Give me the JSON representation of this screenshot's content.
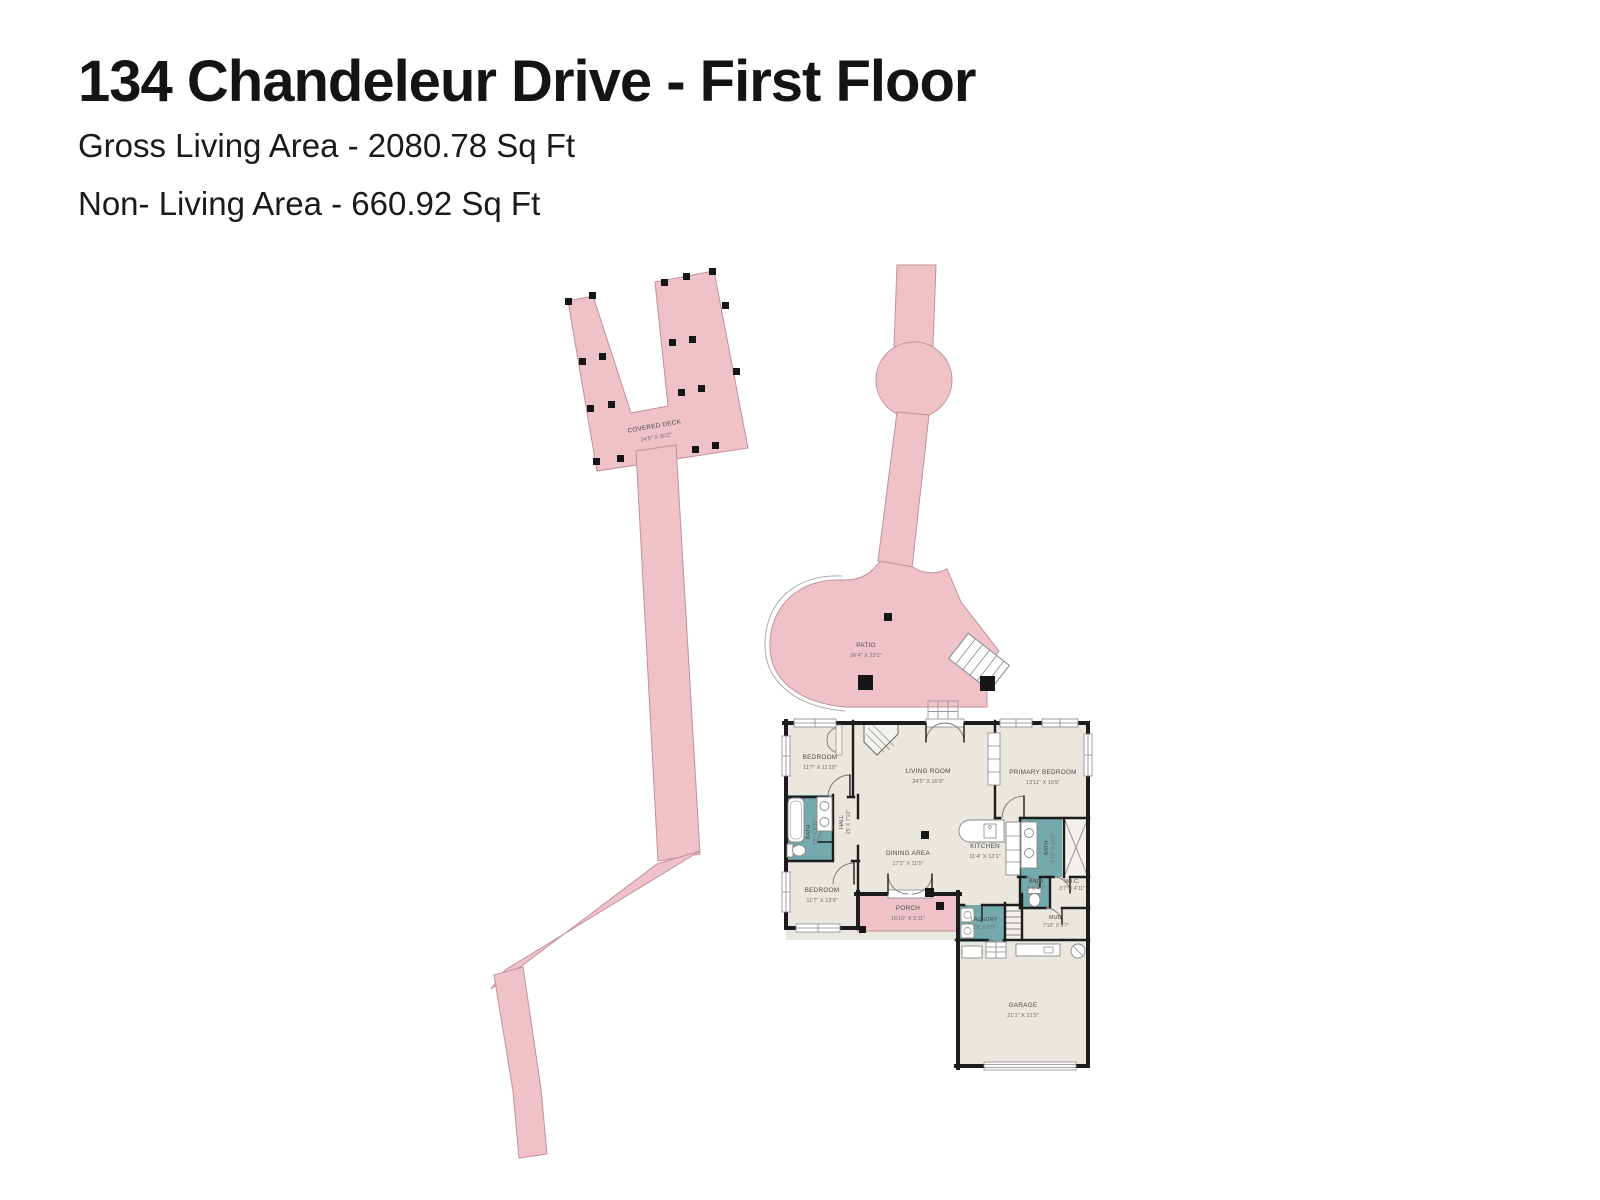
{
  "header": {
    "title": "134 Chandeleur Drive - First Floor",
    "gross_living": "Gross Living Area - 2080.78 Sq Ft",
    "non_living": "Non- Living Area - 660.92 Sq Ft"
  },
  "colors": {
    "outdoor_pink": "#eec2c8",
    "outdoor_stroke": "#c49099",
    "floor_beige": "#e9e7de",
    "bath_teal": "#74a9ae",
    "wall_black": "#1c1c1c"
  },
  "plan": {
    "covered_deck": {
      "label": "COVERED DECK",
      "dims": "24'5\" X 30'2\""
    },
    "patio": {
      "label": "PATIO",
      "dims": "36'4\" X 23'1\""
    },
    "bedroom1": {
      "label": "BEDROOM",
      "dims": "11'7\" X 11'10\""
    },
    "living_room": {
      "label": "LIVING ROOM",
      "dims": "24'5\" X 16'9\""
    },
    "primary_bedroom": {
      "label": "PRIMARY BEDROOM",
      "dims": "13'11\" X 16'5\""
    },
    "bath1": {
      "label": "BATH",
      "dims": "7'5\" X 9'10\""
    },
    "hall": {
      "label": "HALL",
      "dims": "25' X 7'10\""
    },
    "dining": {
      "label": "DINING AREA",
      "dims": "17'2\" X 11'5\""
    },
    "kitchen": {
      "label": "KITCHEN",
      "dims": "11'4\" X 13'1\""
    },
    "primary_bath": {
      "label": "BATH",
      "dims": "5'10\" X 14'3\""
    },
    "bedroom2": {
      "label": "BEDROOM",
      "dims": "11'7\" X 13'9\""
    },
    "porch": {
      "label": "PORCH",
      "dims": "16'10\" X 5'11\""
    },
    "laundry": {
      "label": "LAUNDRY",
      "dims": "7'5\" X 6'9\""
    },
    "bath2": {
      "label": "BATH",
      "dims": "5' X 4'7\""
    },
    "wic": {
      "label": "W.I.C.",
      "dims": "3'7\" X 4'11\""
    },
    "mud": {
      "label": "MUD.",
      "dims": "7'10\" X 5'7\""
    },
    "garage": {
      "label": "GARAGE",
      "dims": "21'1\" X 21'5\""
    }
  }
}
